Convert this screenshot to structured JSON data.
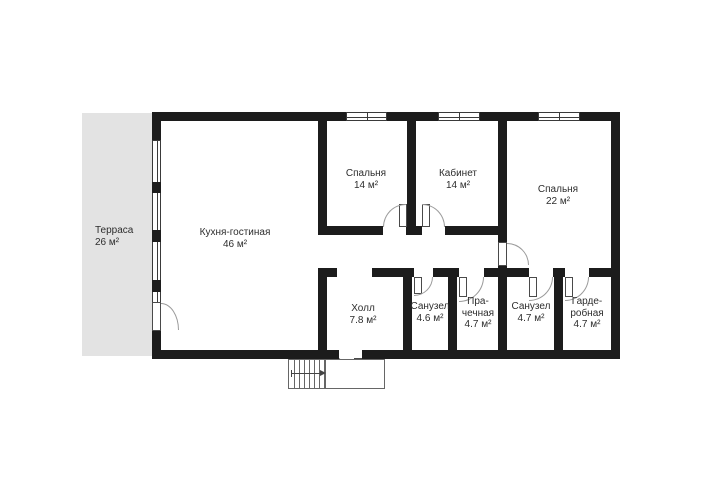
{
  "plan": {
    "rooms": [
      {
        "id": "terrace",
        "name": "Терраса",
        "area": "26 м²"
      },
      {
        "id": "kitchen-living",
        "name": "Кухня-гостиная",
        "area": "46 м²"
      },
      {
        "id": "bedroom-1",
        "name": "Спальня",
        "area": "14 м²"
      },
      {
        "id": "study",
        "name": "Кабинет",
        "area": "14 м²"
      },
      {
        "id": "bedroom-2",
        "name": "Спальня",
        "area": "22 м²"
      },
      {
        "id": "hall",
        "name": "Холл",
        "area": "7.8 м²"
      },
      {
        "id": "bathroom-1",
        "name": "Санузел",
        "area": "4.6 м²"
      },
      {
        "id": "laundry",
        "name": "Пра-\nчечная",
        "area": "4.7 м²"
      },
      {
        "id": "bathroom-2",
        "name": "Санузел",
        "area": "4.7 м²"
      },
      {
        "id": "wardrobe",
        "name": "Гарде-\nробная",
        "area": "4.7 м²"
      }
    ],
    "colors": {
      "wall": "#1c1c1c",
      "terrace_fill": "#e3e3e3",
      "text": "#2d2d2d",
      "door_arc": "#9a9a9a",
      "outline": "#666666",
      "background": "#ffffff"
    }
  }
}
